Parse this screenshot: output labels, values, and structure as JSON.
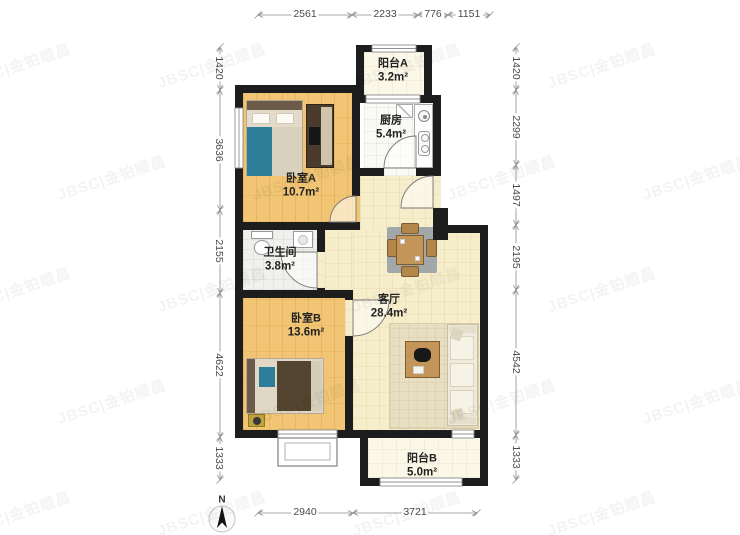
{
  "watermark": {
    "text": "JBSC|金铂顺昌"
  },
  "compass": {
    "label": "N"
  },
  "rooms": [
    {
      "id": "bedroom-a",
      "name": "卧室A",
      "area": "10.7m²"
    },
    {
      "id": "balcony-a",
      "name": "阳台A",
      "area": "3.2m²"
    },
    {
      "id": "kitchen",
      "name": "厨房",
      "area": "5.4m²"
    },
    {
      "id": "bathroom",
      "name": "卫生间",
      "area": "3.8m²"
    },
    {
      "id": "living-room",
      "name": "客厅",
      "area": "28.4m²"
    },
    {
      "id": "bedroom-b",
      "name": "卧室B",
      "area": "13.6m²"
    },
    {
      "id": "balcony-b",
      "name": "阳台B",
      "area": "5.0m²"
    }
  ],
  "dimensions": {
    "top": [
      "2561",
      "2233",
      "776",
      "1151"
    ],
    "bottom": [
      "2940",
      "3721"
    ],
    "left": [
      "1420",
      "3636",
      "2155",
      "4622",
      "1333"
    ],
    "right": [
      "1420",
      "2299",
      "1497",
      "2195",
      "4542",
      "1333"
    ]
  },
  "colors": {
    "wall": "#1D1D1D",
    "bedroom_floor": "#F1C573",
    "living_floor": "#F6EECB",
    "balcony_floor": "#FBF8E8",
    "accent_teal": "#2E7E99",
    "wood": "#C49559",
    "dim_line": "#8C8C8C"
  }
}
